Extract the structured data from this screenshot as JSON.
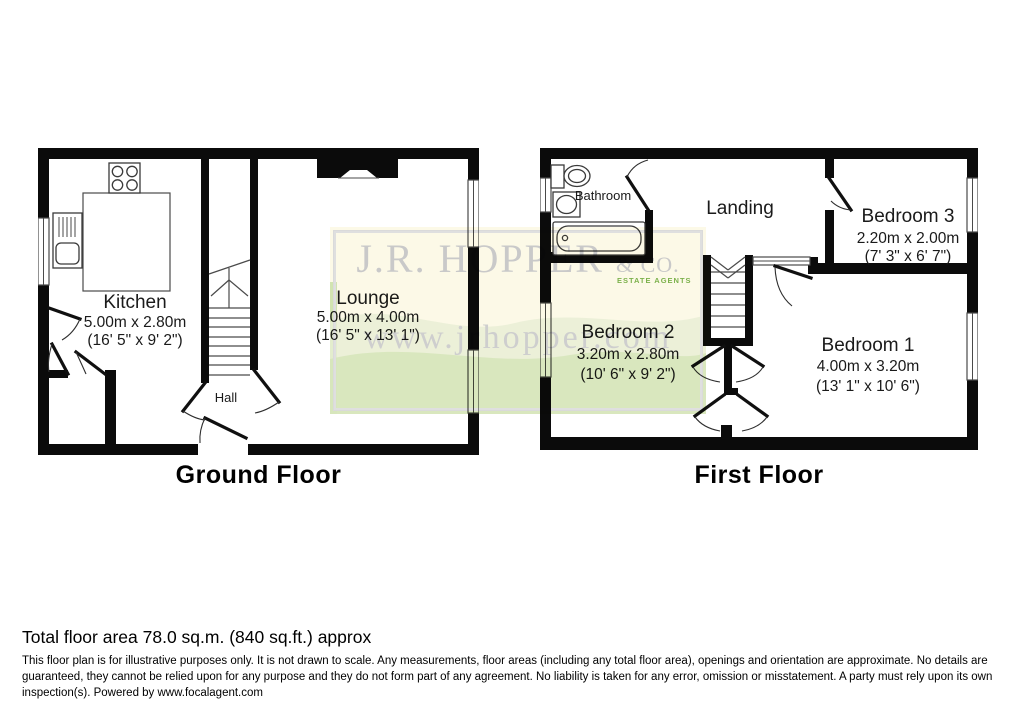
{
  "watermark": {
    "line1": "J.R. HOPPER",
    "amp": "& CO.",
    "badge": "ESTATE AGENTS",
    "url": "www.jrhopper.com"
  },
  "ground_floor": {
    "title": "Ground Floor",
    "rooms": {
      "kitchen": {
        "name": "Kitchen",
        "dims_m": "5.00m x 2.80m",
        "dims_ft": "(16' 5\" x 9' 2\")"
      },
      "lounge": {
        "name": "Lounge",
        "dims_m": "5.00m x 4.00m",
        "dims_ft": "(16' 5\" x 13' 1\")"
      },
      "hall": {
        "name": "Hall"
      }
    }
  },
  "first_floor": {
    "title": "First Floor",
    "rooms": {
      "bathroom": {
        "name": "Bathroom"
      },
      "landing": {
        "name": "Landing"
      },
      "bedroom3": {
        "name": "Bedroom 3",
        "dims_m": "2.20m x 2.00m",
        "dims_ft": "(7' 3\" x 6' 7\")"
      },
      "bedroom2": {
        "name": "Bedroom 2",
        "dims_m": "3.20m x 2.80m",
        "dims_ft": "(10' 6\" x 9' 2\")"
      },
      "bedroom1": {
        "name": "Bedroom 1",
        "dims_m": "4.00m x 3.20m",
        "dims_ft": "(13' 1\" x 10' 6\")"
      }
    }
  },
  "footer": {
    "total_area": "Total floor area 78.0 sq.m. (840 sq.ft.) approx",
    "disclaimer": "This floor plan is for illustrative purposes only. It is not drawn to scale. Any measurements, floor areas (including any total floor area), openings and orientation are approximate. No details are guaranteed, they cannot be relied upon for any purpose and they do not form part of any agreement. No liability is taken for any error, omission or misstatement. A party must rely upon its own inspection(s). Powered by www.focalagent.com"
  },
  "colors": {
    "wall": "#0b0b0b",
    "watermark_text": "#c6c6c6",
    "watermark_bg": "#fcf9e6",
    "watermark_green": "#cde2a8"
  }
}
